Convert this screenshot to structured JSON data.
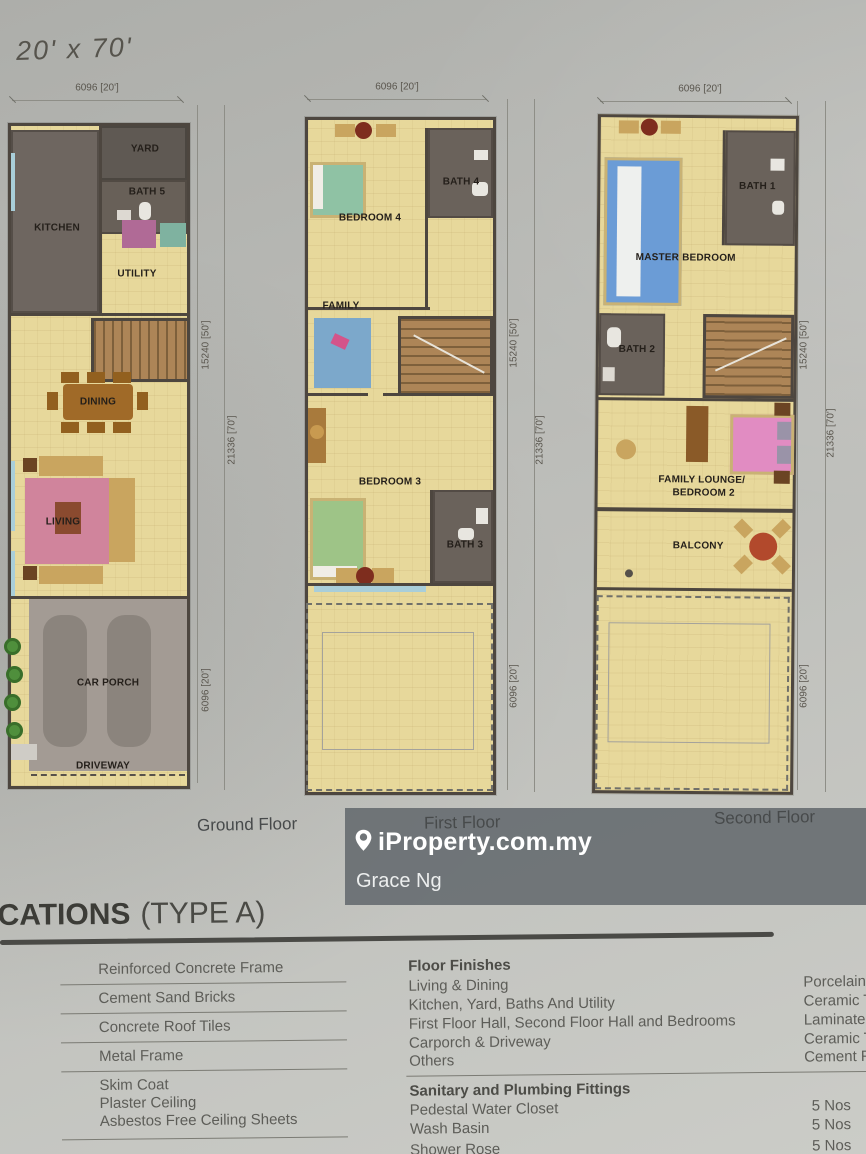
{
  "page": {
    "title": "20' x 70'"
  },
  "plans": [
    {
      "name": "Ground Floor",
      "dims": {
        "top": "6096 [20']",
        "upper": "15240 [50']",
        "outer": "21336 [70']",
        "lower": "6096 [20']"
      },
      "rooms": {
        "kitchen": "KITCHEN",
        "yard": "YARD",
        "bath5": "BATH 5",
        "utility": "UTILITY",
        "dining": "DINING",
        "living": "LIVING",
        "carporch": "CAR PORCH",
        "driveway": "DRIVEWAY"
      }
    },
    {
      "name": "First Floor",
      "dims": {
        "top": "6096 [20']",
        "upper": "15240 [50']",
        "outer": "21336 [70']",
        "lower": "6096 [20']"
      },
      "rooms": {
        "bedroom4": "BEDROOM 4",
        "bath4": "BATH 4",
        "family": "FAMILY",
        "bedroom3": "BEDROOM 3",
        "bath3": "BATH 3"
      }
    },
    {
      "name": "Second Floor",
      "dims": {
        "top": "6096 [20']",
        "upper": "15240 [50']",
        "outer": "21336 [70']",
        "lower": "6096 [20']"
      },
      "rooms": {
        "master": "MASTER BEDROOM",
        "bath1": "BATH 1",
        "bath2": "BATH 2",
        "lounge1": "FAMILY LOUNGE/",
        "lounge2": "BEDROOM 2",
        "balcony": "BALCONY"
      }
    }
  ],
  "watermark": {
    "brand": "iProperty.com.my",
    "agent": "Grace Ng"
  },
  "specs": {
    "heading_bold": "CATIONS",
    "heading_regular": "(TYPE A)",
    "structure_items": [
      {
        "lines": [
          "Reinforced Concrete Frame"
        ]
      },
      {
        "lines": [
          "Cement Sand Bricks"
        ]
      },
      {
        "lines": [
          "Concrete Roof Tiles"
        ]
      },
      {
        "lines": [
          "Metal Frame"
        ]
      },
      {
        "lines": [
          "Skim Coat",
          "Plaster Ceiling",
          "Asbestos Free Ceiling Sheets"
        ]
      }
    ],
    "floor_finishes": {
      "heading": "Floor Finishes",
      "rows": [
        {
          "label": "Living & Dining",
          "value": "Porcelain"
        },
        {
          "label": "Kitchen, Yard, Baths And Utility",
          "value": "Ceramic T"
        },
        {
          "label": "First Floor Hall, Second Floor Hall and Bedrooms",
          "value": "Laminate"
        },
        {
          "label": "Carporch & Driveway",
          "value": "Ceramic T"
        },
        {
          "label": "Others",
          "value": "Cement F"
        }
      ]
    },
    "sanitary": {
      "heading": "Sanitary and Plumbing Fittings",
      "rows": [
        {
          "label": "Pedestal Water Closet",
          "value": "5 Nos"
        },
        {
          "label": "Wash Basin",
          "value": "5 Nos"
        },
        {
          "label": "Shower Rose",
          "value": "5 Nos"
        }
      ]
    }
  }
}
